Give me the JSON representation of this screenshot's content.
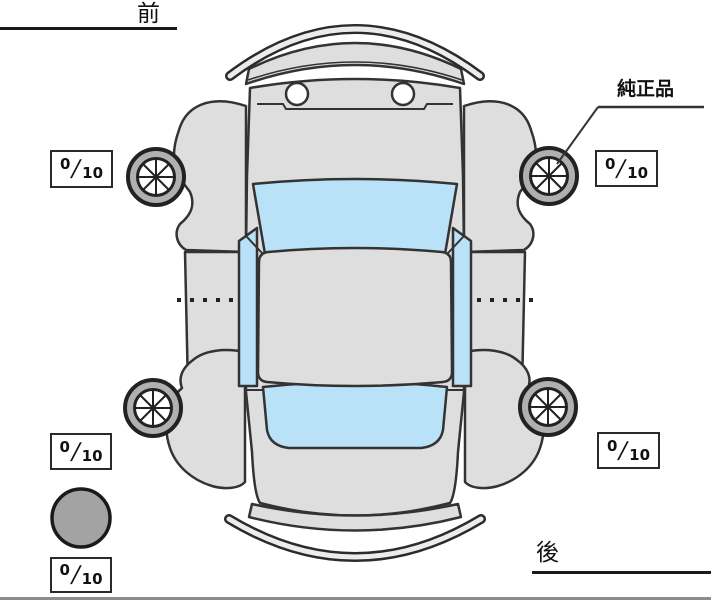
{
  "labels": {
    "front": "前",
    "rear": "後",
    "genuine_part": "純正品"
  },
  "tread_scores": {
    "front_left": {
      "value": "0",
      "separator": "/",
      "max": "10"
    },
    "front_right": {
      "value": "0",
      "separator": "/",
      "max": "10"
    },
    "rear_left": {
      "value": "0",
      "separator": "/",
      "max": "10"
    },
    "rear_right": {
      "value": "0",
      "separator": "/",
      "max": "10"
    },
    "spare": {
      "value": "0",
      "separator": "/",
      "max": "10"
    }
  },
  "colors": {
    "body": "#dedede",
    "window": "#b9e1f8",
    "wheel_ring": "#b0b0b0",
    "spare_tire": "#a3a3a3",
    "outline": "#333333",
    "background": "#ffffff"
  }
}
